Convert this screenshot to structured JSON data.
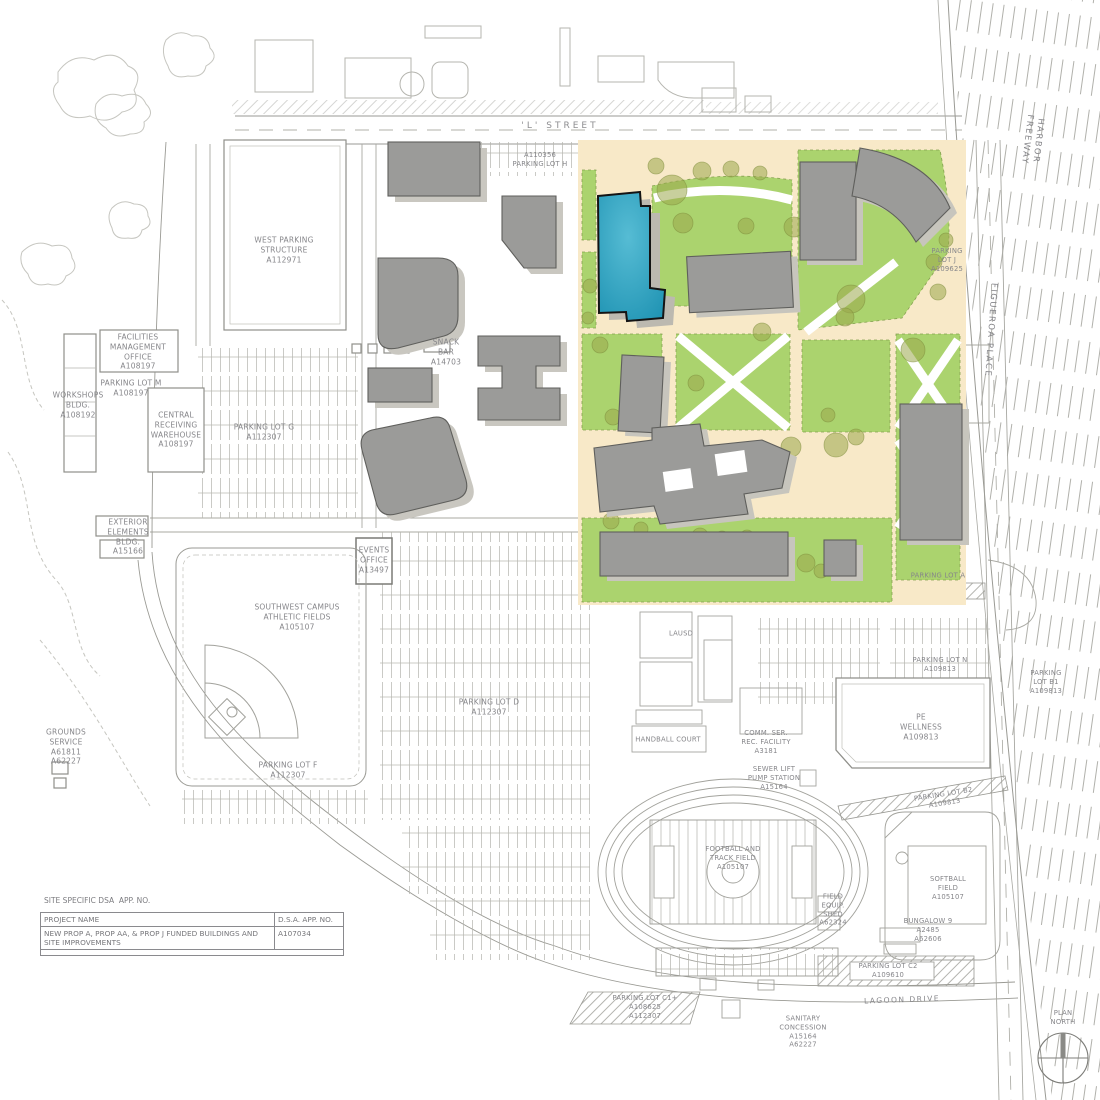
{
  "meta": {
    "drawing_type": "campus site plan",
    "sheet": "site specific DSA application map"
  },
  "colors": {
    "highlight_building": "#2f9fbe",
    "lawn_green": "#abd36e",
    "walk_tan": "#f8e9c8",
    "building_gray": "#9b9b99",
    "tree_olive": "#9aa84c",
    "linework": "#9a9a94"
  },
  "labels": {
    "l_street": "'L' STREET",
    "parking_lot_h": "A110356\nPARKING LOT H",
    "west_parking": "WEST PARKING\nSTRUCTURE\nA112971",
    "facilities_mgmt": "FACILITIES\nMANAGEMENT\nOFFICE\nA108197",
    "parking_lot_m": "PARKING LOT M\nA108197",
    "workshops": "WORKSHOPS\nBLDG.\nA108192",
    "central_receiving": "CENTRAL\nRECEIVING\nWAREHOUSE\nA108197",
    "snack_bar": "SNACK\nBAR\nA14703",
    "parking_lot_g": "PARKING LOT G\nA112307",
    "exterior_elements": "EXTERIOR\nELEMENTS\nBLDG.\nA15166",
    "events_office": "EVENTS\nOFFICE\nA13497",
    "sw_fields": "SOUTHWEST CAMPUS\nATHLETIC FIELDS\nA105107",
    "grounds_service": "GROUNDS\nSERVICE\nA61811\nA62227",
    "parking_lot_f": "PARKING LOT F\nA112307",
    "parking_lot_d": "PARKING LOT D\nA112307",
    "lausd": "LAUSD",
    "handball": "HANDBALL COURT",
    "comm_ser": "COMM. SER.\nREC. FACILITY\nA3181",
    "sewer_lift": "SEWER LIFT\nPUMP STATION\nA15164",
    "pe_wellness": "PE\nWELLNESS\nA109813",
    "parking_lot_n": "PARKING LOT N\nA109813",
    "parking_lot_b1": "PARKING\nLOT B1\nA109813",
    "parking_lot_a": "PARKING LOT A",
    "parking_lot_j": "PARKING\nLOT J\nA109625",
    "football": "FOOTBALL AND\nTRACK FIELD\nA105107",
    "field_shed": "FIELD\nEQUIP.\nSHED\nA62324",
    "softball": "SOFTBALL\nFIELD\nA105107",
    "bungalow": "BUNGALOW 9\nA2485\nA62606",
    "parking_lot_b2": "PARKING LOT B2\nA109813",
    "parking_lot_c1": "PARKING LOT C1+\nA108625\nA112307",
    "parking_lot_c2": "PARKING LOT C2\nA109610",
    "lagoon_drive": "LAGOON DRIVE",
    "sanitary": "SANITARY\nCONCESSION\nA15164\nA62227",
    "harbor_freeway": "HARBOR FREEWAY",
    "figueroa": "FIGUEROA PLACE",
    "plan_north": "PLAN\nNORTH"
  },
  "title_block": {
    "site_specific": "SITE SPECIFIC DSA  APP. NO.",
    "project_name_header": "PROJECT NAME",
    "dsa_header": "D.S.A. APP. NO.",
    "project_name_value": "NEW PROP A, PROP AA, & PROP J FUNDED BUILDINGS AND SITE IMPROVEMENTS",
    "dsa_value": "A107034"
  }
}
